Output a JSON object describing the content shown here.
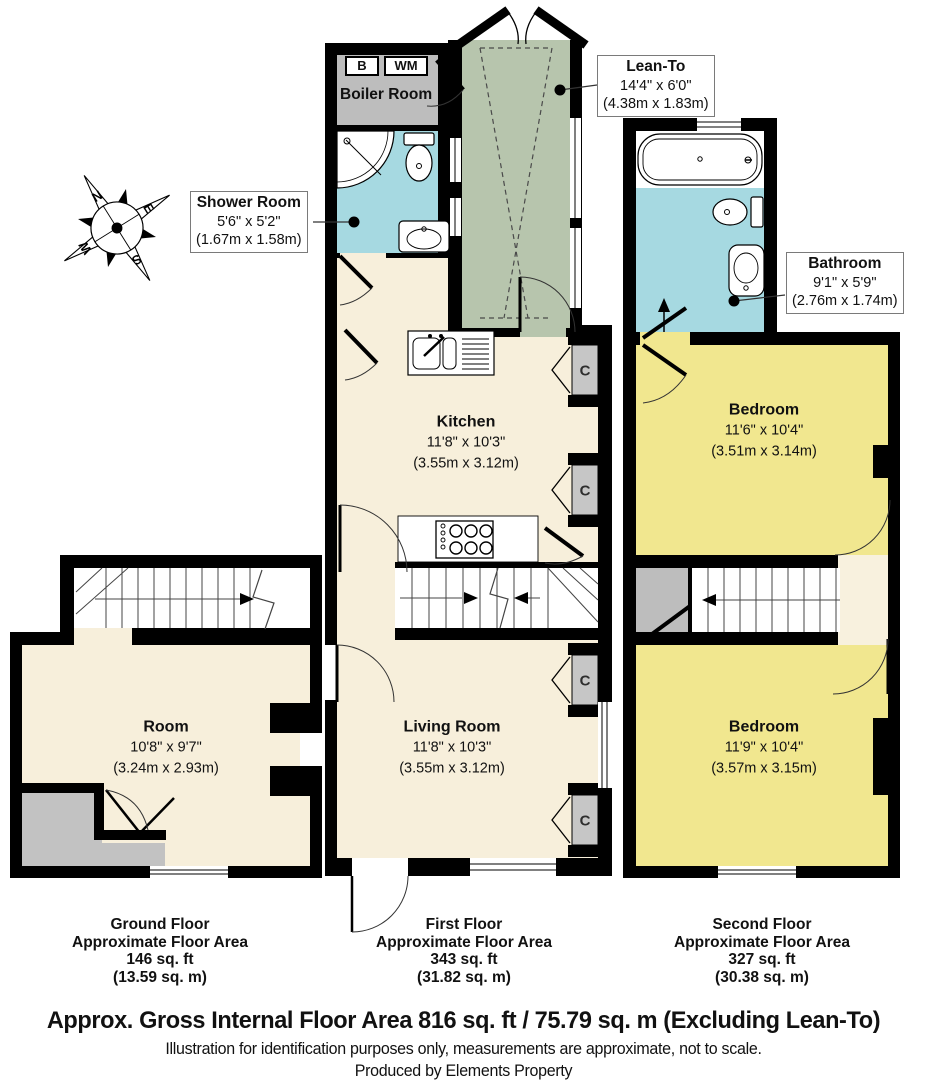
{
  "compass": {
    "n": "N",
    "e": "E",
    "s": "S",
    "w": "W"
  },
  "labels": {
    "cupboard": "C",
    "boiler_b": "B",
    "boiler_wm": "WM"
  },
  "rooms": {
    "boiler": {
      "name": "Boiler Room"
    },
    "shower": {
      "name": "Shower Room",
      "dim_ft": "5'6\" x 5'2\"",
      "dim_m": "(1.67m x 1.58m)"
    },
    "lean_to": {
      "name": "Lean-To",
      "dim_ft": "14'4\" x 6'0\"",
      "dim_m": "(4.38m x 1.83m)"
    },
    "kitchen": {
      "name": "Kitchen",
      "dim_ft": "11'8\" x 10'3\"",
      "dim_m": "(3.55m x 3.12m)"
    },
    "living": {
      "name": "Living Room",
      "dim_ft": "11'8\" x 10'3\"",
      "dim_m": "(3.55m x 3.12m)"
    },
    "room": {
      "name": "Room",
      "dim_ft": "10'8\" x 9'7\"",
      "dim_m": "(3.24m x 2.93m)"
    },
    "bathroom": {
      "name": "Bathroom",
      "dim_ft": "9'1\" x 5'9\"",
      "dim_m": "(2.76m x 1.74m)"
    },
    "bedroom1": {
      "name": "Bedroom",
      "dim_ft": "11'6\" x 10'4\"",
      "dim_m": "(3.51m x 3.14m)"
    },
    "bedroom2": {
      "name": "Bedroom",
      "dim_ft": "11'9\" x 10'4\"",
      "dim_m": "(3.57m x 3.15m)"
    }
  },
  "floors": {
    "ground": {
      "title": "Ground Floor",
      "subtitle": "Approximate Floor Area",
      "area_ft": "146 sq. ft",
      "area_m": "(13.59 sq. m)"
    },
    "first": {
      "title": "First Floor",
      "subtitle": "Approximate Floor Area",
      "area_ft": "343 sq. ft",
      "area_m": "(31.82 sq. m)"
    },
    "second": {
      "title": "Second Floor",
      "subtitle": "Approximate Floor Area",
      "area_ft": "327 sq. ft",
      "area_m": "(30.38 sq. m)"
    }
  },
  "footer": {
    "gross": "Approx. Gross Internal Floor Area 816 sq. ft / 75.79 sq. m (Excluding Lean-To)",
    "disclaimer": "Illustration for identification purposes only, measurements are approximate, not to scale.",
    "producer": "Produced by Elements Property"
  },
  "colors": {
    "wall": "#000000",
    "cream": "#f7efdb",
    "yellow": "#f1e78f",
    "blue": "#a6d9e1",
    "green": "#b7c5ad",
    "gray": "#bdbdbd"
  }
}
